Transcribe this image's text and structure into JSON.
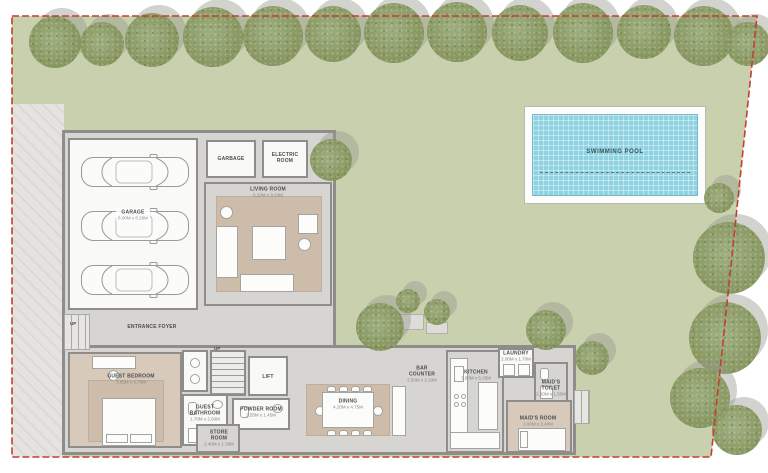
{
  "plan_title": "villa-ground-floor-site-plan",
  "colors": {
    "lawn": "#c8d0ad",
    "pool_water": "#8fd2e1",
    "boundary_red": "#c23f30",
    "wall_gray": "#8e8d8b",
    "floor_gray": "#d6d5d2",
    "carpet_beige": "#d8cabb",
    "paving": "#e4e3e0",
    "tree_green": "#87975f"
  },
  "pool": {
    "label": "SWIMMING POOL"
  },
  "rooms": {
    "garage": {
      "label": "GARAGE",
      "dims": "6.00M x 8.20M"
    },
    "garbage": {
      "label": "GARBAGE"
    },
    "electric": {
      "label": "ELECTRIC ROOM"
    },
    "living": {
      "label": "LIVING ROOM",
      "dims": "6.20M x 9.20M"
    },
    "foyer": {
      "label": "ENTRANCE FOYER",
      "up": "UP"
    },
    "stairs": {
      "up": "UP"
    },
    "lift": {
      "label": "LIFT"
    },
    "guest_bedroom": {
      "label": "GUEST BEDROOM",
      "dims": "3.85M x 4.70M"
    },
    "guest_bathroom": {
      "label": "GUEST BATHROOM",
      "dims": "1.70M x 2.60M"
    },
    "powder": {
      "label": "POWDER ROOM",
      "dims": "2.55M x 1.45M"
    },
    "store": {
      "label": "STORE ROOM",
      "dims": "2.40M x 1.30M"
    },
    "dining": {
      "label": "DINING",
      "dims": "4.20M x 4.75M"
    },
    "bar": {
      "label": "BAR COUNTER",
      "dims": "2.50M x 2.20M"
    },
    "kitchen": {
      "label": "KITCHEN",
      "dims": "3.80M x 5.35M"
    },
    "laundry": {
      "label": "LAUNDRY",
      "dims": "2.00M x 1.70M"
    },
    "maids_toilet": {
      "label": "MAID'S TOILET",
      "dims": "2.00M x 1.50M"
    },
    "maids_room": {
      "label": "MAID'S ROOM",
      "dims": "3.00M x 2.40M"
    }
  },
  "site": {
    "trees": [
      {
        "x": 55,
        "y": 42,
        "r": 26
      },
      {
        "x": 102,
        "y": 44,
        "r": 22
      },
      {
        "x": 152,
        "y": 40,
        "r": 27
      },
      {
        "x": 213,
        "y": 37,
        "r": 30
      },
      {
        "x": 273,
        "y": 36,
        "r": 30
      },
      {
        "x": 333,
        "y": 34,
        "r": 28
      },
      {
        "x": 394,
        "y": 33,
        "r": 30
      },
      {
        "x": 457,
        "y": 32,
        "r": 30
      },
      {
        "x": 520,
        "y": 33,
        "r": 28
      },
      {
        "x": 583,
        "y": 33,
        "r": 30
      },
      {
        "x": 644,
        "y": 32,
        "r": 27
      },
      {
        "x": 704,
        "y": 36,
        "r": 30
      },
      {
        "x": 748,
        "y": 44,
        "r": 22
      },
      {
        "x": 719,
        "y": 198,
        "r": 15
      },
      {
        "x": 729,
        "y": 258,
        "r": 36
      },
      {
        "x": 725,
        "y": 338,
        "r": 36
      },
      {
        "x": 700,
        "y": 398,
        "r": 30
      },
      {
        "x": 737,
        "y": 430,
        "r": 25
      },
      {
        "x": 331,
        "y": 160,
        "r": 21
      },
      {
        "x": 380,
        "y": 327,
        "r": 24
      },
      {
        "x": 408,
        "y": 301,
        "r": 12
      },
      {
        "x": 437,
        "y": 312,
        "r": 13
      },
      {
        "x": 546,
        "y": 330,
        "r": 20
      },
      {
        "x": 592,
        "y": 358,
        "r": 17
      }
    ]
  }
}
